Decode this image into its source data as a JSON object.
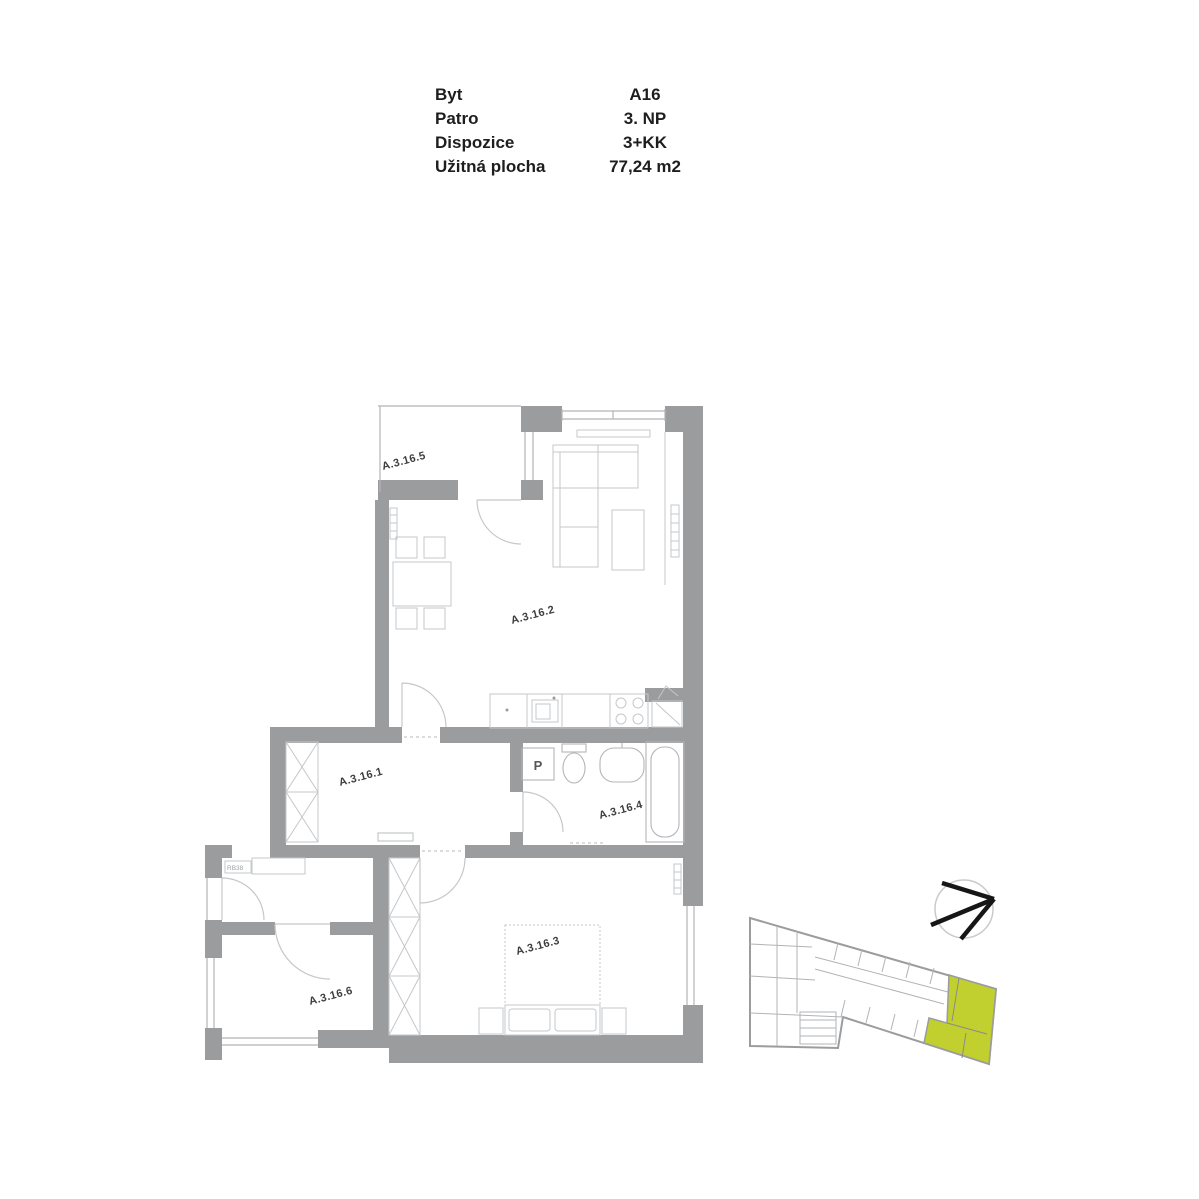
{
  "header": {
    "rows": [
      {
        "label": "Byt",
        "value": "A16"
      },
      {
        "label": "Patro",
        "value": "3. NP"
      },
      {
        "label": "Dispozice",
        "value": "3+KK"
      },
      {
        "label": "Užitná plocha",
        "value": "77,24 m2"
      }
    ]
  },
  "floor_plan": {
    "rooms": [
      {
        "code": "A.3.16.1",
        "name": "hallway"
      },
      {
        "code": "A.3.16.2",
        "name": "living-room-kitchen"
      },
      {
        "code": "A.3.16.3",
        "name": "bedroom"
      },
      {
        "code": "A.3.16.4",
        "name": "bathroom"
      },
      {
        "code": "A.3.16.5",
        "name": "terrace"
      },
      {
        "code": "A.3.16.6",
        "name": "room"
      }
    ],
    "annotations": {
      "washing_machine": "P",
      "entry_door": "RB38"
    },
    "colors": {
      "wall": "#9b9c9e",
      "furniture": "#c6c7c9",
      "fixture": "#b4b5b7",
      "label": "#3d3e40"
    }
  },
  "site_plan": {
    "highlight_color": "#c1d02f",
    "outline_color": "#9b9c9e",
    "north_arrow_color": "#161616"
  }
}
